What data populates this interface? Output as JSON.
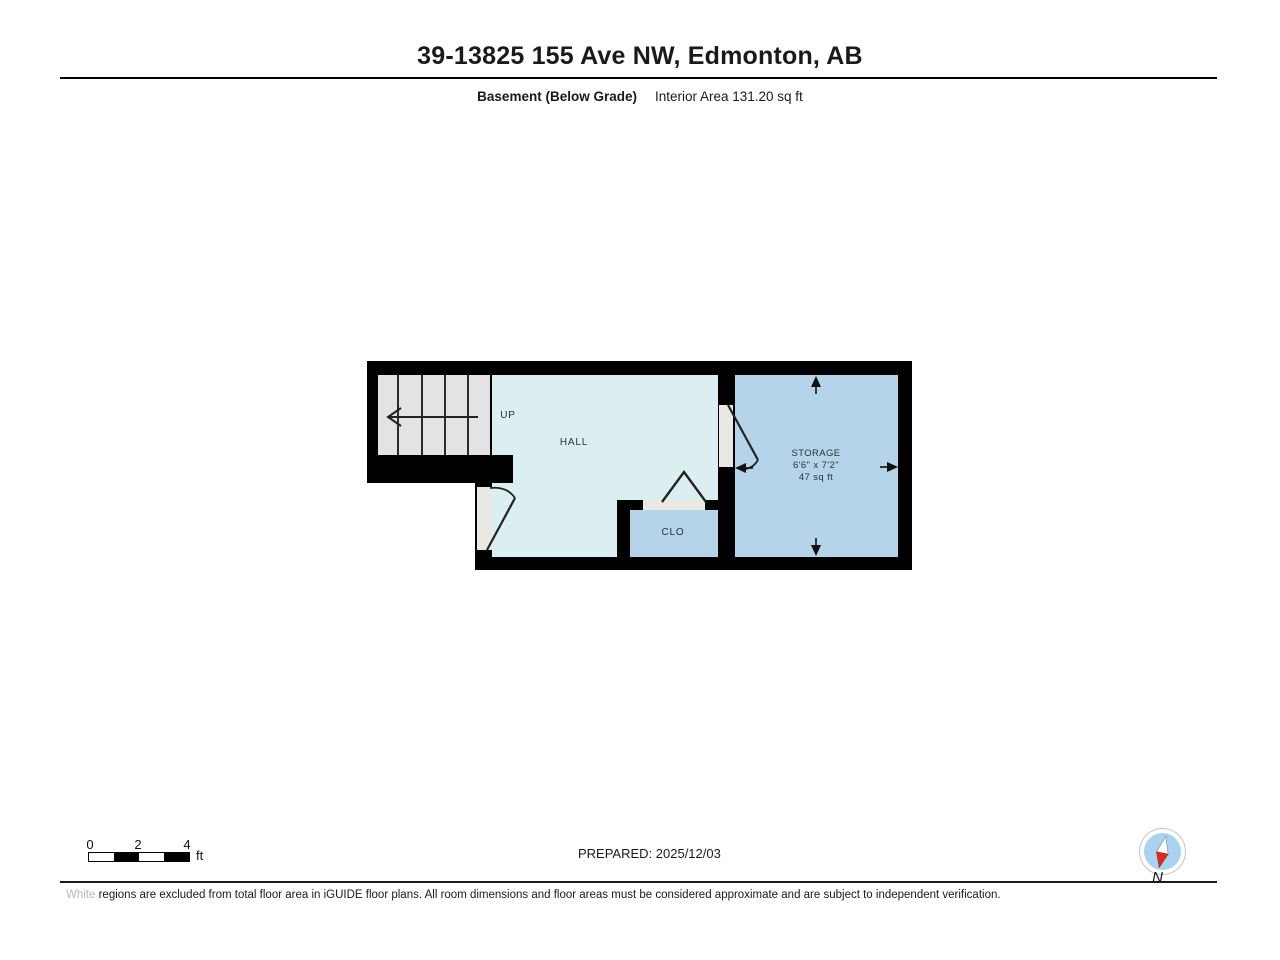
{
  "colors": {
    "wall": "#000000",
    "hall-fill": "#dceff0",
    "storage-fill": "#b5d4ea",
    "stairs-fill": "#e3e3e3",
    "threshold-fill": "#eae8e3",
    "compass-ring": "#ffffff",
    "compass-face": "#a9d3f1",
    "needle-red": "#d62e1f"
  },
  "header": {
    "title": "39-13825 155 Ave NW, Edmonton, AB",
    "floor_label": "Basement (Below Grade)",
    "area_label": "Interior Area 131.20 sq ft"
  },
  "plan": {
    "up_label": "UP",
    "hall": "HALL",
    "closet": "CLO",
    "storage_name": "STORAGE",
    "storage_dimensions": "6'6\" x 7'2\"",
    "storage_area": "47 sq ft"
  },
  "footer": {
    "scale_ticks": [
      "0",
      "2",
      "4"
    ],
    "scale_unit": "ft",
    "prepared": "PREPARED: 2025/12/03",
    "compass_label": "N",
    "disclaimer_word": "White",
    "disclaimer_rest": " regions are excluded from total floor area in iGUIDE floor plans. All room dimensions and floor areas must be considered approximate and are subject to independent verification."
  }
}
